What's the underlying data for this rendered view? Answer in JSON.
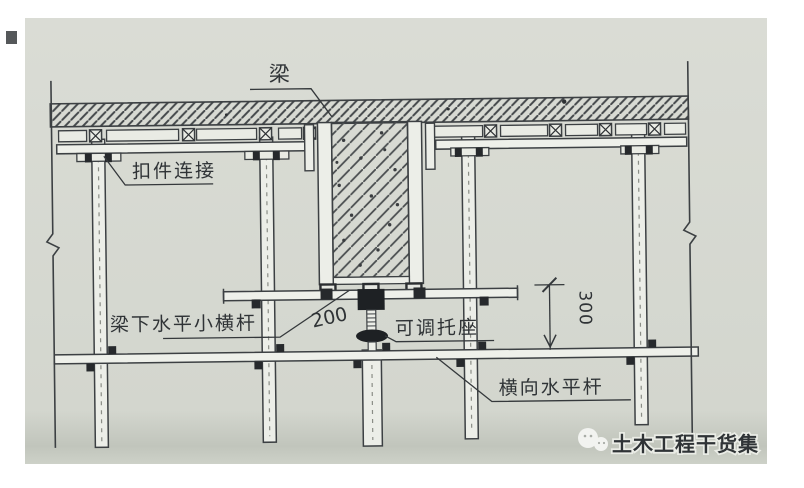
{
  "labels": {
    "beam": "梁",
    "coupler_connection": "扣件连接",
    "beam_bottom_bar": "梁下水平小横杆",
    "dim_200": "200",
    "adjustable_bracket": "可调托座",
    "dim_300": "300",
    "transverse_bar": "横向水平杆"
  },
  "watermark": {
    "text": "土木工程干货集"
  },
  "colors": {
    "paper": "#d7dad2",
    "ink": "#3c4043",
    "hatch": "#4a4e50",
    "fitting_black": "#1e2124",
    "watermark_gray": "#8d9093",
    "watermark_halo": "#eaece6"
  }
}
